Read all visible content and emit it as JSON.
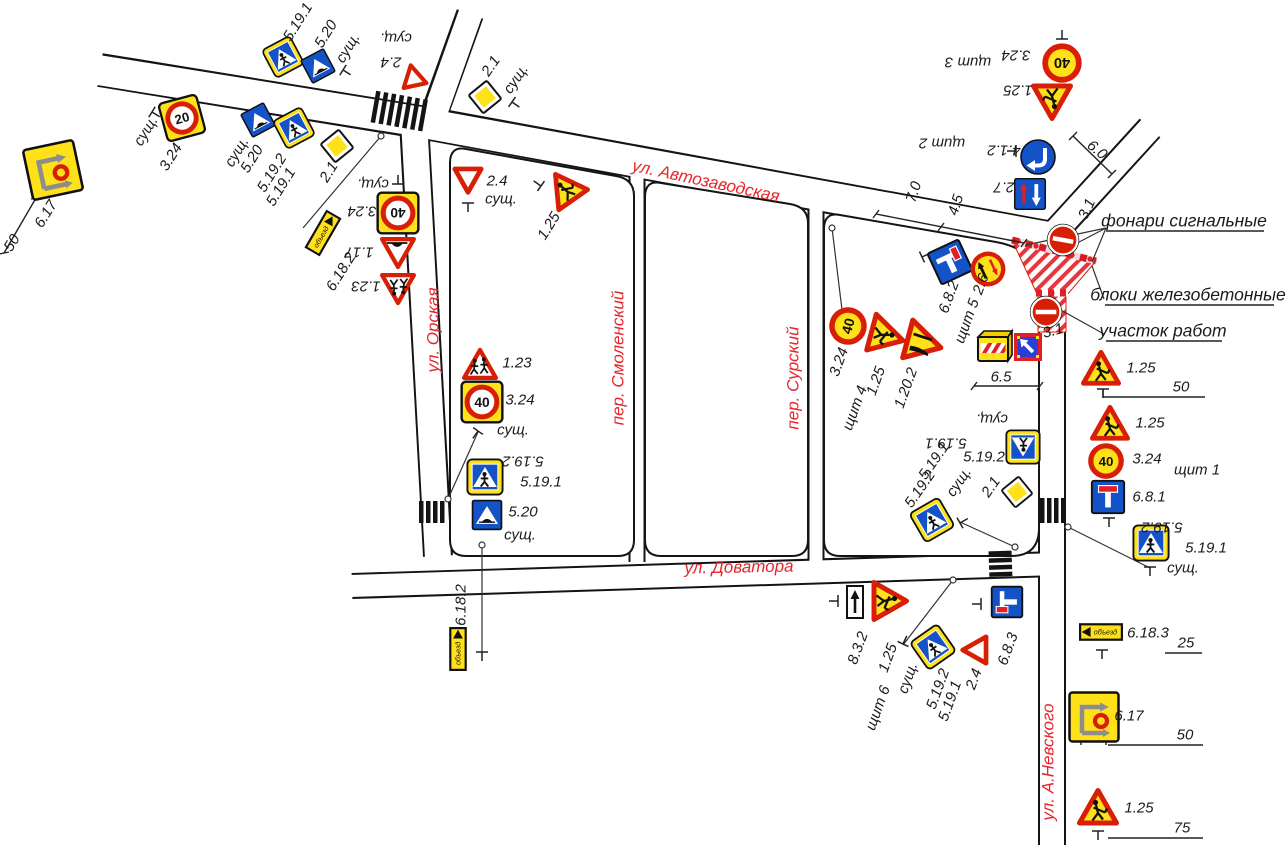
{
  "drawing_type": "Схема организации дорожного движения и ограждения участка работ",
  "streets": [
    "ул. Автозаводская",
    "ул. Орская",
    "пер. Смоленский",
    "пер. Сурский",
    "ул. Доватора",
    "ул. А.Невского"
  ],
  "annotations": [
    "фонари сигнальные",
    "блоки железобетонные",
    "участок работ"
  ],
  "shields": [
    "щит 1",
    "щит 2",
    "щит 3",
    "щит 4",
    "щит 5",
    "щит 6"
  ],
  "dimensions": [
    "6.0",
    "7.0",
    "4.5",
    "3.1",
    "3.1",
    "6.5",
    "50",
    "50",
    "25",
    "50",
    "75"
  ],
  "colors": {
    "street_label": "#e8252b",
    "sign_red": "#d81e05",
    "sign_yellow": "#ffe11a",
    "sign_blue": "#1452c8",
    "work_zone_hatch": "#e8343c"
  },
  "signs": [
    {
      "code": "5.19.1",
      "type": "ped",
      "x": 283,
      "y": 57,
      "rot": -28,
      "s": 34
    },
    {
      "code": "5.20",
      "type": "hump",
      "x": 318,
      "y": 66,
      "rot": -28,
      "s": 30
    },
    {
      "code": "2.4",
      "type": "giveway",
      "x": 413,
      "y": 76,
      "rot": 168,
      "s": 30
    },
    {
      "code": "3.24",
      "type": "sqspeed",
      "x": 182,
      "y": 118,
      "rot": -15,
      "s": 42,
      "num": "20"
    },
    {
      "code": "5.20",
      "type": "hump",
      "x": 258,
      "y": 120,
      "rot": -28,
      "s": 30
    },
    {
      "code": "5.19.2",
      "type": "ped",
      "x": 294,
      "y": 128,
      "rot": -28,
      "s": 34
    },
    {
      "code": "2.1",
      "type": "diamond",
      "x": 337,
      "y": 146,
      "rot": 6,
      "s": 36
    },
    {
      "code": "6.17",
      "type": "detour_sq",
      "x": 53,
      "y": 170,
      "rot": -12,
      "s": 54
    },
    {
      "code": "2.1",
      "type": "diamond",
      "x": 485,
      "y": 97,
      "rot": 6,
      "s": 36
    },
    {
      "code": "2.4",
      "type": "giveway",
      "x": 468,
      "y": 180,
      "rot": 0,
      "s": 34
    },
    {
      "code": "1.25",
      "type": "warn",
      "x": 565,
      "y": 188,
      "rot": -35,
      "s": 40,
      "glyph": "worker",
      "fill": "yellow"
    },
    {
      "code": "3.24",
      "type": "sqspeed",
      "x": 398,
      "y": 213,
      "rot": 180,
      "s": 44,
      "num": "40"
    },
    {
      "code": "1.17",
      "type": "warn",
      "x": 398,
      "y": 252,
      "rot": 180,
      "s": 36,
      "glyph": "hump",
      "fill": "white"
    },
    {
      "code": "1.23",
      "type": "warn",
      "x": 398,
      "y": 288,
      "rot": 180,
      "s": 36,
      "glyph": "children",
      "fill": "white"
    },
    {
      "code": "6.18.2",
      "type": "detour_rect",
      "x": 323,
      "y": 233,
      "rot": -60,
      "dir": "right",
      "text": "объезд"
    },
    {
      "code": "1.23",
      "type": "warn",
      "x": 480,
      "y": 365,
      "rot": 0,
      "s": 36,
      "glyph": "children",
      "fill": "white"
    },
    {
      "code": "3.24",
      "type": "sqspeed",
      "x": 482,
      "y": 402,
      "rot": 0,
      "s": 44,
      "num": "40"
    },
    {
      "code": "5.19.2",
      "type": "ped",
      "x": 485,
      "y": 477,
      "rot": 0,
      "s": 38
    },
    {
      "code": "5.20",
      "type": "hump",
      "x": 487,
      "y": 515,
      "rot": 0,
      "s": 34
    },
    {
      "code": "6.18.2",
      "type": "detour_rect",
      "x": 458,
      "y": 649,
      "rot": -90,
      "dir": "right",
      "text": "объезд"
    },
    {
      "code": "3.24",
      "type": "circspeed",
      "x": 1062,
      "y": 63,
      "rot": 180,
      "s": 42,
      "num": "40"
    },
    {
      "code": "1.25",
      "type": "warn",
      "x": 1052,
      "y": 101,
      "rot": 180,
      "s": 42,
      "glyph": "worker",
      "fill": "yellow"
    },
    {
      "code": "4.1.2",
      "type": "turn",
      "x": 1038,
      "y": 157,
      "rot": 180,
      "s": 40
    },
    {
      "code": "2.7",
      "type": "prio",
      "x": 1030,
      "y": 194,
      "rot": 180,
      "s": 36
    },
    {
      "code": "3.1",
      "type": "noentry",
      "x": 1063,
      "y": 240,
      "rot": 10,
      "s": 36
    },
    {
      "code": "3.1",
      "type": "noentry",
      "x": 1046,
      "y": 312,
      "rot": 0,
      "s": 36
    },
    {
      "code": "6.8.2",
      "type": "deadend2",
      "x": 950,
      "y": 262,
      "rot": -25,
      "s": 40
    },
    {
      "code": "2.6",
      "type": "prio_circ",
      "x": 988,
      "y": 269,
      "rot": -25,
      "s": 38
    },
    {
      "code": "3.24",
      "type": "circspeed",
      "x": 848,
      "y": 326,
      "rot": -75,
      "s": 40,
      "num": "40"
    },
    {
      "code": "1.25",
      "type": "warn",
      "x": 886,
      "y": 336,
      "rot": 105,
      "s": 42,
      "glyph": "worker",
      "fill": "yellow"
    },
    {
      "code": "1.20.2",
      "type": "warn",
      "x": 923,
      "y": 343,
      "rot": 105,
      "s": 44,
      "glyph": "narrow",
      "fill": "yellow"
    },
    {
      "code": "",
      "type": "barrier",
      "x": 995,
      "y": 347,
      "rot": 0
    },
    {
      "code": "",
      "type": "board",
      "x": 1028,
      "y": 347,
      "rot": 0
    },
    {
      "code": "1.25",
      "type": "warn",
      "x": 1101,
      "y": 369,
      "rot": 0,
      "s": 40,
      "glyph": "worker",
      "fill": "yellow"
    },
    {
      "code": "1.25",
      "type": "warn",
      "x": 1110,
      "y": 424,
      "rot": 0,
      "s": 40,
      "glyph": "worker",
      "fill": "yellow"
    },
    {
      "code": "3.24",
      "type": "circspeed",
      "x": 1106,
      "y": 461,
      "rot": 0,
      "s": 38,
      "num": "40"
    },
    {
      "code": "6.8.1",
      "type": "deadend1",
      "x": 1108,
      "y": 497,
      "rot": 0,
      "s": 38
    },
    {
      "code": "5.19.1",
      "type": "ped",
      "x": 1151,
      "y": 543,
      "rot": 0,
      "s": 38
    },
    {
      "code": "5.19.1",
      "type": "ped",
      "x": 1023,
      "y": 447,
      "rot": 180,
      "s": 36
    },
    {
      "code": "2.1",
      "type": "diamond",
      "x": 1017,
      "y": 492,
      "rot": 6,
      "s": 34
    },
    {
      "code": "5.19.2",
      "type": "ped",
      "x": 932,
      "y": 520,
      "rot": -30,
      "s": 36
    },
    {
      "code": "8.3.2",
      "type": "plate",
      "x": 855,
      "y": 602,
      "rot": 0
    },
    {
      "code": "1.25",
      "type": "warn",
      "x": 889,
      "y": 601,
      "rot": 90,
      "s": 42,
      "glyph": "worker",
      "fill": "yellow"
    },
    {
      "code": "5.19.1",
      "type": "ped",
      "x": 933,
      "y": 647,
      "rot": -35,
      "s": 36
    },
    {
      "code": "2.4",
      "type": "giveway",
      "x": 975,
      "y": 650,
      "rot": 90,
      "s": 34
    },
    {
      "code": "6.8.3",
      "type": "deadend3",
      "x": 1007,
      "y": 602,
      "rot": -90,
      "s": 36
    },
    {
      "code": "6.18.3",
      "type": "detour_rect",
      "x": 1101,
      "y": 632,
      "rot": 0,
      "dir": "left",
      "text": "объезд"
    },
    {
      "code": "6.17",
      "type": "detour_sq",
      "x": 1094,
      "y": 717,
      "rot": 0,
      "s": 52
    },
    {
      "code": "1.25",
      "type": "warn",
      "x": 1098,
      "y": 808,
      "rot": 0,
      "s": 42,
      "glyph": "worker",
      "fill": "yellow"
    }
  ],
  "labels": [
    {
      "t": "5.19.1",
      "x": 298,
      "y": 22,
      "r": -58,
      "c": "code"
    },
    {
      "t": "5.20",
      "x": 326,
      "y": 34,
      "r": -58,
      "c": "code"
    },
    {
      "t": "сущ.",
      "x": 348,
      "y": 48,
      "r": -58,
      "c": "exist"
    },
    {
      "t": "сущ.",
      "x": 396,
      "y": 38,
      "r": 180,
      "c": "exist"
    },
    {
      "t": "2.4",
      "x": 391,
      "y": 62,
      "r": 180,
      "c": "code"
    },
    {
      "t": "сущ.",
      "x": 237,
      "y": 152,
      "r": -58,
      "c": "exist"
    },
    {
      "t": "5.20",
      "x": 252,
      "y": 159,
      "r": -58,
      "c": "code"
    },
    {
      "t": "5.19.2",
      "x": 272,
      "y": 173,
      "r": -58,
      "c": "code"
    },
    {
      "t": "5.19.1",
      "x": 281,
      "y": 187,
      "r": -58,
      "c": "code"
    },
    {
      "t": "2.1",
      "x": 329,
      "y": 172,
      "r": -58,
      "c": "code"
    },
    {
      "t": "сущ.",
      "x": 146,
      "y": 131,
      "r": -58,
      "c": "exist"
    },
    {
      "t": "3.24",
      "x": 171,
      "y": 157,
      "r": -58,
      "c": "code"
    },
    {
      "t": "6.17",
      "x": 46,
      "y": 214,
      "r": -58,
      "c": "code"
    },
    {
      "t": "50",
      "x": 12,
      "y": 243,
      "r": -58,
      "c": "dim"
    },
    {
      "t": "6.18.2",
      "x": 341,
      "y": 272,
      "r": -58,
      "c": "code"
    },
    {
      "t": "сущ.",
      "x": 373,
      "y": 184,
      "r": 180,
      "c": "exist"
    },
    {
      "t": "3.24",
      "x": 362,
      "y": 211,
      "r": 180,
      "c": "code"
    },
    {
      "t": "1.17",
      "x": 359,
      "y": 252,
      "r": 180,
      "c": "code"
    },
    {
      "t": "1.23",
      "x": 366,
      "y": 286,
      "r": 180,
      "c": "code"
    },
    {
      "t": "ул. Орская",
      "x": 433,
      "y": 330,
      "r": -90,
      "c": "street"
    },
    {
      "t": "2.1",
      "x": 491,
      "y": 66,
      "r": -55,
      "c": "code"
    },
    {
      "t": "сущ.",
      "x": 516,
      "y": 79,
      "r": -55,
      "c": "exist"
    },
    {
      "t": "2.4",
      "x": 497,
      "y": 181,
      "r": 0,
      "c": "code"
    },
    {
      "t": "сущ.",
      "x": 501,
      "y": 199,
      "r": 0,
      "c": "exist"
    },
    {
      "t": "1.25",
      "x": 549,
      "y": 226,
      "r": -58,
      "c": "code"
    },
    {
      "t": "ул. Автозаводская",
      "x": 706,
      "y": 181,
      "r": 12,
      "c": "street"
    },
    {
      "t": "щит 3",
      "x": 968,
      "y": 62,
      "r": 180,
      "c": "shield"
    },
    {
      "t": "3.24",
      "x": 1016,
      "y": 55,
      "r": 180,
      "c": "code"
    },
    {
      "t": "1.25",
      "x": 1018,
      "y": 90,
      "r": 180,
      "c": "code"
    },
    {
      "t": "щит 2",
      "x": 942,
      "y": 143,
      "r": 180,
      "c": "shield"
    },
    {
      "t": "4.1.2",
      "x": 1004,
      "y": 150,
      "r": 180,
      "c": "code"
    },
    {
      "t": "2.7",
      "x": 1004,
      "y": 187,
      "r": 180,
      "c": "code"
    },
    {
      "t": "6.0",
      "x": 1097,
      "y": 150,
      "r": 40,
      "c": "dim"
    },
    {
      "t": "7.0",
      "x": 914,
      "y": 192,
      "r": -72,
      "c": "dim"
    },
    {
      "t": "4.5",
      "x": 956,
      "y": 205,
      "r": -72,
      "c": "dim"
    },
    {
      "t": "3.1",
      "x": 1087,
      "y": 209,
      "r": -65,
      "c": "code"
    },
    {
      "t": "фонари сигнальные",
      "x": 1184,
      "y": 221,
      "r": 0,
      "c": "note"
    },
    {
      "t": "блоки железобетонные",
      "x": 1188,
      "y": 295,
      "r": 0,
      "c": "note"
    },
    {
      "t": "участок работ",
      "x": 1163,
      "y": 331,
      "r": 0,
      "c": "note"
    },
    {
      "t": "3.1",
      "x": 1053,
      "y": 331,
      "r": -15,
      "c": "code"
    },
    {
      "t": "6.8.2",
      "x": 949,
      "y": 297,
      "r": -70,
      "c": "code"
    },
    {
      "t": "2.6",
      "x": 981,
      "y": 284,
      "r": -70,
      "c": "code"
    },
    {
      "t": "щит 5",
      "x": 967,
      "y": 321,
      "r": -70,
      "c": "shield"
    },
    {
      "t": "3.24",
      "x": 839,
      "y": 362,
      "r": -70,
      "c": "code"
    },
    {
      "t": "1.25",
      "x": 876,
      "y": 381,
      "r": -70,
      "c": "code"
    },
    {
      "t": "щит 4",
      "x": 855,
      "y": 408,
      "r": -70,
      "c": "shield"
    },
    {
      "t": "1.20.2",
      "x": 906,
      "y": 388,
      "r": -70,
      "c": "code"
    },
    {
      "t": "6.5",
      "x": 1001,
      "y": 377,
      "r": 0,
      "c": "dim"
    },
    {
      "t": "1.25",
      "x": 1141,
      "y": 368,
      "r": 0,
      "c": "code"
    },
    {
      "t": "50",
      "x": 1181,
      "y": 387,
      "r": 0,
      "c": "dim"
    },
    {
      "t": "1.25",
      "x": 1150,
      "y": 423,
      "r": 0,
      "c": "code"
    },
    {
      "t": "3.24",
      "x": 1147,
      "y": 459,
      "r": 0,
      "c": "code"
    },
    {
      "t": "щит 1",
      "x": 1197,
      "y": 470,
      "r": 0,
      "c": "shield"
    },
    {
      "t": "6.8.1",
      "x": 1149,
      "y": 497,
      "r": 0,
      "c": "code"
    },
    {
      "t": "5.19.2",
      "x": 1162,
      "y": 527,
      "r": 180,
      "c": "code"
    },
    {
      "t": "5.19.1",
      "x": 1206,
      "y": 548,
      "r": 0,
      "c": "code"
    },
    {
      "t": "сущ.",
      "x": 1183,
      "y": 568,
      "r": 0,
      "c": "exist"
    },
    {
      "t": "пер. Смоленский",
      "x": 618,
      "y": 358,
      "r": -90,
      "c": "street"
    },
    {
      "t": "пер. Сурский",
      "x": 793,
      "y": 378,
      "r": -90,
      "c": "street"
    },
    {
      "t": "1.23",
      "x": 517,
      "y": 363,
      "r": 0,
      "c": "code"
    },
    {
      "t": "3.24",
      "x": 520,
      "y": 400,
      "r": 0,
      "c": "code"
    },
    {
      "t": "сущ.",
      "x": 513,
      "y": 430,
      "r": 0,
      "c": "exist"
    },
    {
      "t": "5.19.2",
      "x": 523,
      "y": 461,
      "r": 180,
      "c": "code"
    },
    {
      "t": "5.19.1",
      "x": 541,
      "y": 482,
      "r": 0,
      "c": "code"
    },
    {
      "t": "5.20",
      "x": 523,
      "y": 512,
      "r": 0,
      "c": "code"
    },
    {
      "t": "сущ.",
      "x": 520,
      "y": 535,
      "r": 0,
      "c": "exist"
    },
    {
      "t": "сущ.",
      "x": 992,
      "y": 419,
      "r": 180,
      "c": "exist"
    },
    {
      "t": "5.19.1",
      "x": 946,
      "y": 443,
      "r": 180,
      "c": "code"
    },
    {
      "t": "5.19.2",
      "x": 984,
      "y": 457,
      "r": 0,
      "c": "code"
    },
    {
      "t": "5.19.2",
      "x": 920,
      "y": 489,
      "r": -55,
      "c": "code"
    },
    {
      "t": "5.19.1",
      "x": 934,
      "y": 461,
      "r": -55,
      "c": "code"
    },
    {
      "t": "сущ.",
      "x": 959,
      "y": 482,
      "r": -55,
      "c": "exist"
    },
    {
      "t": "2.1",
      "x": 991,
      "y": 487,
      "r": -55,
      "c": "code"
    },
    {
      "t": "ул. Доватора",
      "x": 739,
      "y": 567,
      "r": -1,
      "c": "street"
    },
    {
      "t": "6.18.2",
      "x": 461,
      "y": 605,
      "r": -90,
      "c": "code"
    },
    {
      "t": "8.3.2",
      "x": 858,
      "y": 648,
      "r": -70,
      "c": "code"
    },
    {
      "t": "1.25",
      "x": 888,
      "y": 658,
      "r": -70,
      "c": "code"
    },
    {
      "t": "щит 6",
      "x": 878,
      "y": 708,
      "r": -70,
      "c": "shield"
    },
    {
      "t": "сущ.",
      "x": 908,
      "y": 678,
      "r": -70,
      "c": "exist"
    },
    {
      "t": "5.19.2",
      "x": 938,
      "y": 689,
      "r": -70,
      "c": "code"
    },
    {
      "t": "5.19.1",
      "x": 950,
      "y": 701,
      "r": -70,
      "c": "code"
    },
    {
      "t": "2.4",
      "x": 974,
      "y": 679,
      "r": -70,
      "c": "code"
    },
    {
      "t": "6.8.3",
      "x": 1008,
      "y": 649,
      "r": -70,
      "c": "code"
    },
    {
      "t": "ул. А.Невского",
      "x": 1048,
      "y": 762,
      "r": -90,
      "c": "street"
    },
    {
      "t": "6.18.3",
      "x": 1148,
      "y": 633,
      "r": 0,
      "c": "code"
    },
    {
      "t": "25",
      "x": 1186,
      "y": 643,
      "r": 0,
      "c": "dim"
    },
    {
      "t": "6.17",
      "x": 1129,
      "y": 716,
      "r": 0,
      "c": "code"
    },
    {
      "t": "50",
      "x": 1185,
      "y": 735,
      "r": 0,
      "c": "dim"
    },
    {
      "t": "1.25",
      "x": 1139,
      "y": 808,
      "r": 0,
      "c": "code"
    },
    {
      "t": "75",
      "x": 1182,
      "y": 828,
      "r": 0,
      "c": "dim"
    }
  ]
}
